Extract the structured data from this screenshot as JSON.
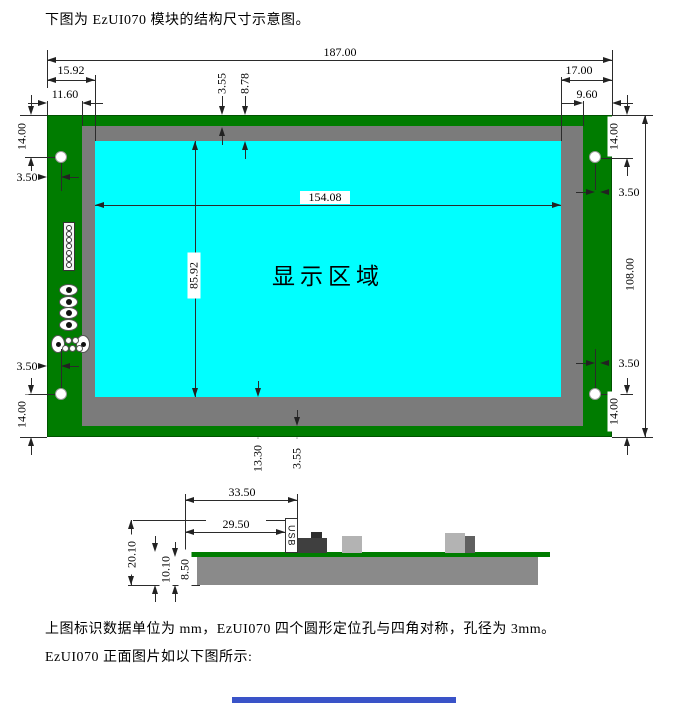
{
  "intro": {
    "text": "下图为 EzUI070 模块的结构尺寸示意图。"
  },
  "front_view": {
    "display_area_label": "显示区域",
    "dims": {
      "total_width": "187.00",
      "total_height": "108.00",
      "display_width": "154.08",
      "display_height": "85.92",
      "edge_to_display_left": "15.92",
      "edge_to_bezel_left": "11.60",
      "edge_to_display_right": "17.00",
      "edge_to_bezel_right": "9.60",
      "edge_strip": "3.55",
      "edge_to_display_top": "8.78",
      "edge_to_display_bottom": "13.30",
      "hole_offset_v": "14.00",
      "hole_offset_h": "3.50"
    }
  },
  "side_view": {
    "usb_label": "USB",
    "dims": {
      "usb_overhang": "33.50",
      "usb_body": "29.50",
      "total_thickness": "20.10",
      "board_to_bottom": "10.10",
      "display_thickness": "8.50"
    }
  },
  "notes": {
    "units_note": "上图标识数据单位为 mm，EzUI070 四个圆形定位孔与四角对称，孔径为 3mm。",
    "next_caption": "EzUI070 正面图片如以下图所示:"
  },
  "colors": {
    "pcb_green": "#007c00",
    "bezel_gray": "#7b7b7b",
    "display_cyan": "#00ffff",
    "slab_gray": "#8a8a8a",
    "component_dark": "#3f3f3f",
    "component_light": "#b3b3b3",
    "next_figure_blue": "#3a53c8"
  }
}
